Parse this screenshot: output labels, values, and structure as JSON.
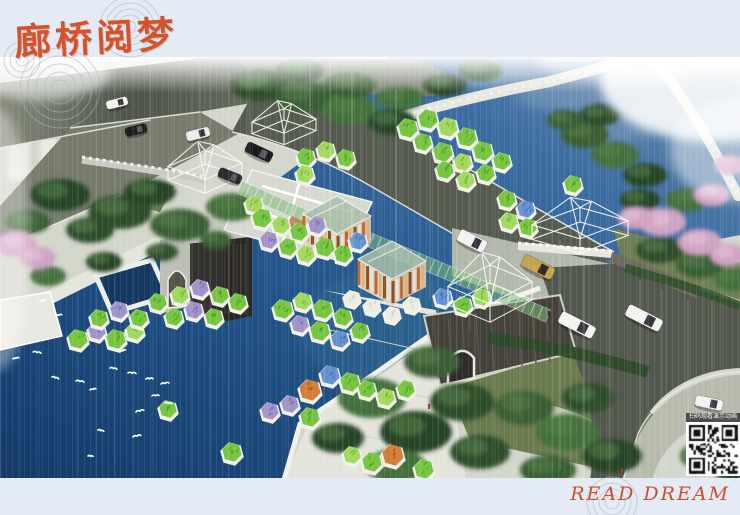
{
  "title": {
    "text": "廊桥阅梦"
  },
  "slogan": {
    "text": "READ DREAM"
  },
  "qr": {
    "caption": "扫码观看演示动画"
  },
  "colors": {
    "background": "#e4ebf4",
    "title": "#d4532c",
    "slogan": "#c94f2e",
    "ripple": "#aab6c2",
    "water_deep": "#143a68",
    "water_mid": "#24568c",
    "water_light": "#7391ad",
    "island_green": "#76c53f",
    "island_light_green": "#a0d95e",
    "island_purple": "#a093cb",
    "island_blue": "#6490d2",
    "island_orange": "#d27d38",
    "island_rim": "#f1f1ea",
    "road": "#5a5f52",
    "road_light": "#858a7a",
    "bank": "#e6e7df",
    "plaza": "#e3e4dc",
    "wall_dark": "#3a3733",
    "tree_green": "#3b5e34",
    "blossom_pink": "#cfa3c3",
    "pavilion_orange": "#c06a32",
    "corridor_green": "#7ebc78",
    "car_white": "#f2f2f0",
    "car_black": "#1c1c1e",
    "car_tan": "#c4a24e",
    "bird_white": "#ffffff"
  }
}
